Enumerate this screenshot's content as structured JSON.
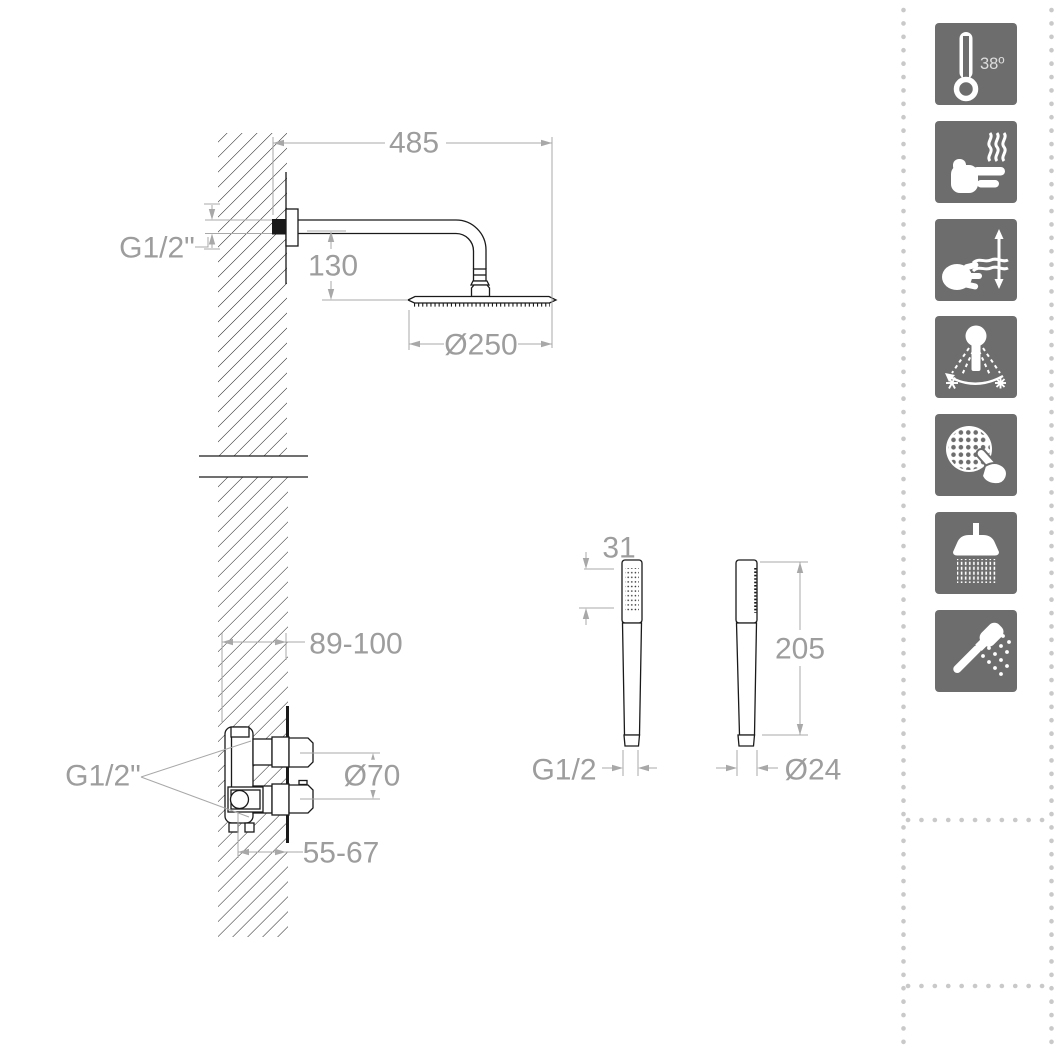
{
  "title": "Built-in thermostatic shower technical drawing",
  "colors": {
    "line": "#1a1a1a",
    "dimension": "#9d9d9d",
    "icon_bg": "#6d6d6d",
    "separator_dots": "#c9c9c9"
  },
  "drawing": {
    "dimensions": {
      "arm_length": "485",
      "arm_thread": "G1/2\"",
      "head_offset": "130",
      "head_diameter": "Ø250",
      "rough_in_depth": "89-100",
      "valve_thread": "G1/2\"",
      "trim_diameter": "Ø70",
      "valve_depth": "55-67",
      "handshower_face": "31",
      "handshower_length": "205",
      "handshower_thread": "G1/2",
      "handshower_diameter": "Ø24"
    }
  },
  "features": {
    "badge": "38º",
    "icons": [
      {
        "name": "thermostat-38-icon"
      },
      {
        "name": "hot-surface-safe-icon"
      },
      {
        "name": "flow-updown-icon"
      },
      {
        "name": "spray-rotation-icon"
      },
      {
        "name": "easy-clean-nozzles-icon"
      },
      {
        "name": "rain-shower-icon"
      },
      {
        "name": "hand-shower-icon"
      }
    ]
  }
}
